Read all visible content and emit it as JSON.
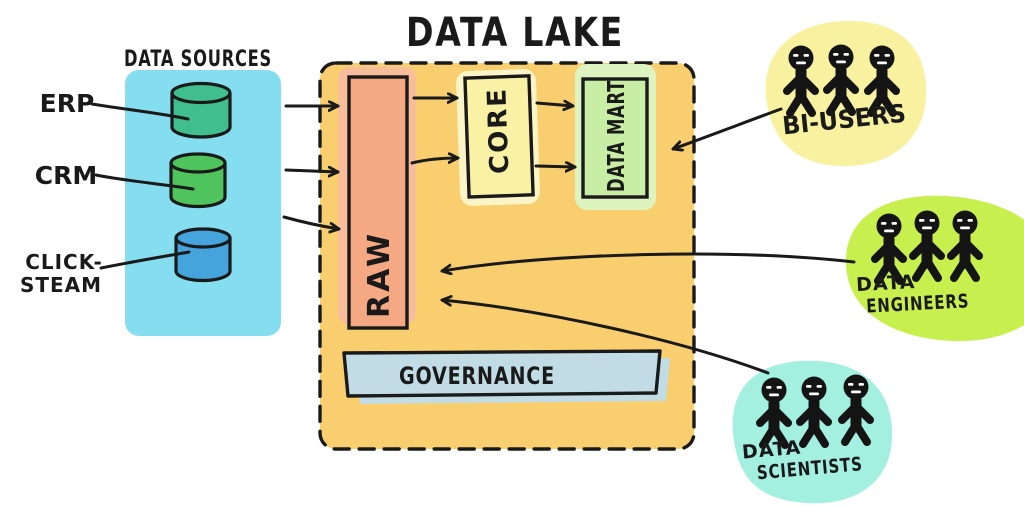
{
  "title": "DATA LAKE",
  "sources": {
    "title": "DATA SOURCES",
    "panel_color": "#85DEEF",
    "items": [
      {
        "label": "ERP",
        "color": "#41BE8D"
      },
      {
        "label": "CRM",
        "color": "#4FC45D"
      },
      {
        "label_line1": "CLICK-",
        "label_line2": "STEAM",
        "color": "#44A4DB"
      }
    ]
  },
  "lake": {
    "fill": "#F8CE6E",
    "raw": {
      "label": "RAW",
      "color": "#F5A982",
      "halo_color": "#F8BD9B"
    },
    "core": {
      "label": "CORE",
      "color": "#F9F2A4",
      "halo_color": "#FBF4C6"
    },
    "data_mart": {
      "label": "DATA MART",
      "color": "#C8EDA4",
      "halo_color": "#DDF3C0"
    },
    "governance": {
      "label": "GOVERNANCE",
      "color": "#C2DCE5"
    }
  },
  "users": {
    "bi": {
      "label": "BI-USERS",
      "blob_color": "#F7F1A0"
    },
    "engineers": {
      "label_line1": "DATA",
      "label_line2": "ENGINEERS",
      "blob_color": "#C7F04F"
    },
    "scientists": {
      "label_line1": "DATA",
      "label_line2": "SCIENTISTS",
      "blob_color": "#A3EFE0"
    }
  }
}
